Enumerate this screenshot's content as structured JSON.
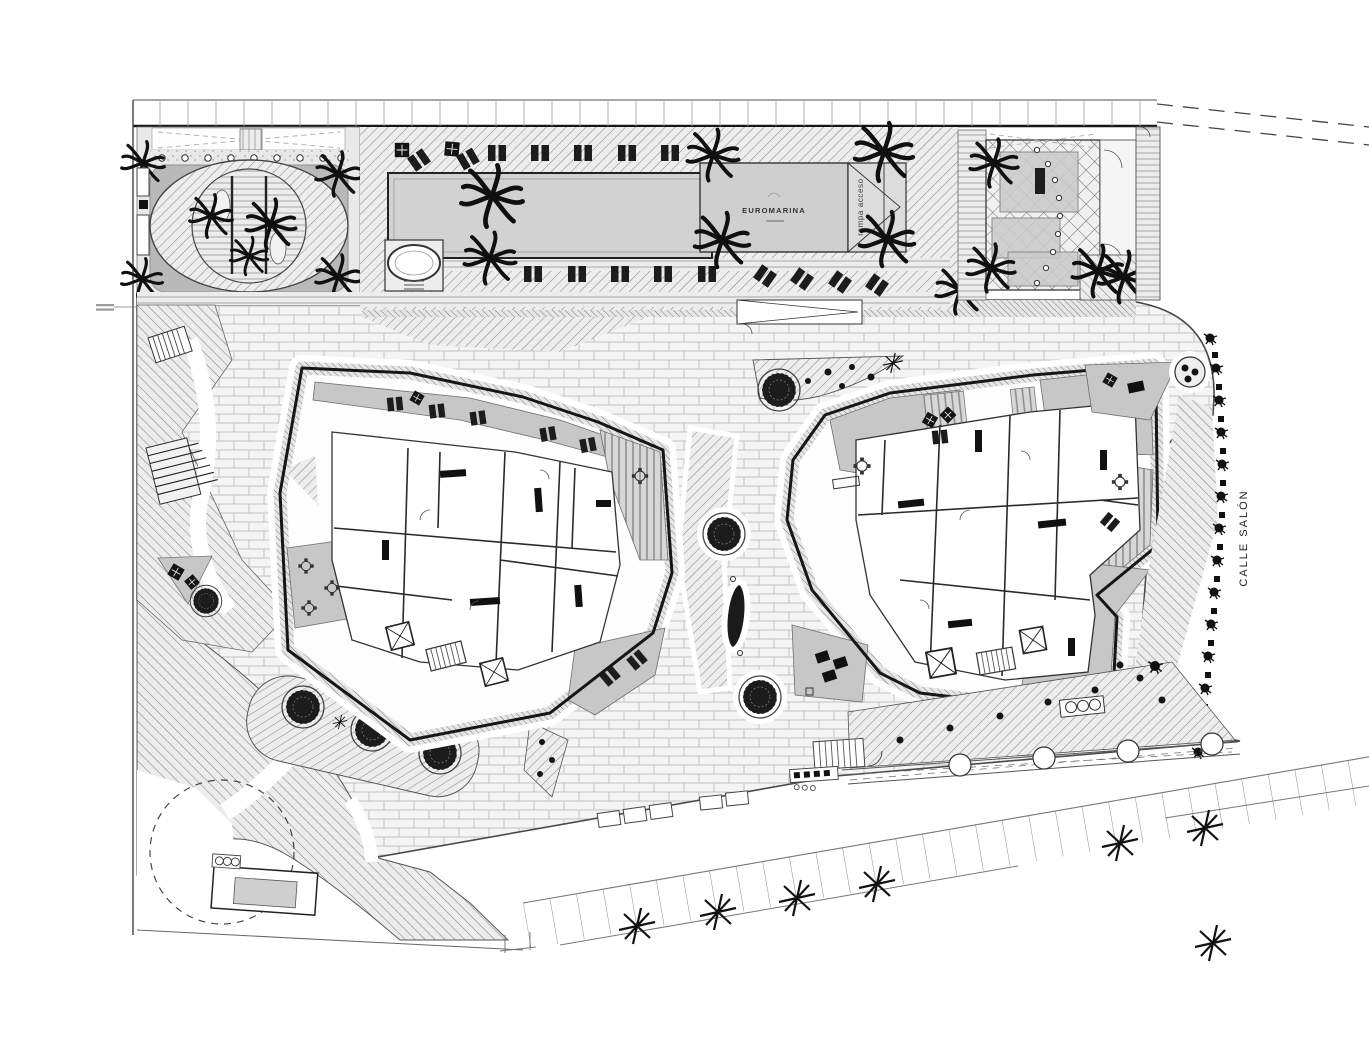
{
  "meta": {
    "type": "architectural site plan",
    "style": "grayscale CAD line drawing, plan view"
  },
  "labels": {
    "building": "EUROMARINA",
    "ramp": "rampa acceso",
    "street": "CALLE SALÓN"
  },
  "colors": {
    "paper": "#ffffff",
    "ink": "#161616",
    "terrace_gray": "#c7c7c7",
    "pool_gray": "#d2d2d2",
    "canopy_dark": "#111111",
    "hatch_line": "#777777",
    "brick_line": "#c2c2c2"
  },
  "icons": {
    "palm_tree": "radial frond burst",
    "street_palm": "8-point star",
    "planter_tree": "dark filled circle with dashed ring",
    "parasol": "tilted dark square",
    "sun_lounger": "paired dark rectangles",
    "elevator": "square with X brace",
    "stairs": "striped rectangle",
    "spa": "oval tub with steps"
  }
}
